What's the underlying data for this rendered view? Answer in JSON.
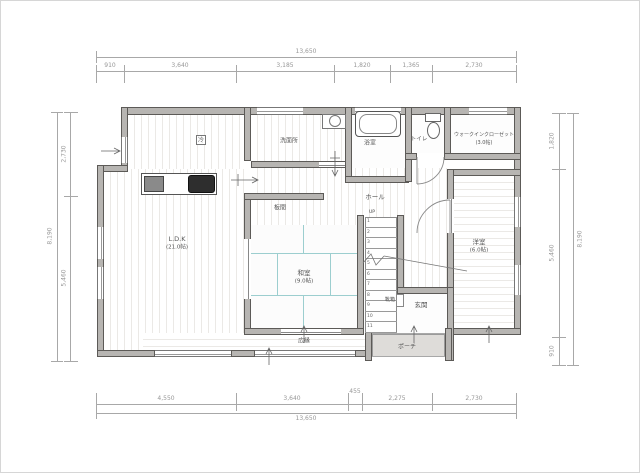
{
  "dimensions": {
    "top": {
      "total": "13,650",
      "segments": [
        "910",
        "3,640",
        "3,185",
        "1,820",
        "1,365",
        "2,730"
      ]
    },
    "bottom": {
      "total": "13,650",
      "segments": [
        "4,550",
        "3,640",
        "455",
        "2,275",
        "2,730"
      ]
    },
    "left": {
      "total": "8,190",
      "segments": [
        "2,730",
        "5,460"
      ]
    },
    "right": {
      "total": "8,190",
      "segments": [
        "1,820",
        "5,460",
        "910"
      ]
    }
  },
  "rooms": {
    "ldk": {
      "name": "L.D.K",
      "size": "(21.0帖)"
    },
    "washitsu": {
      "name": "和室",
      "size": "(9.0帖)"
    },
    "youshitsu": {
      "name": "洋室",
      "size": "(6.0帖)"
    },
    "wic": {
      "name": "ウォークインクローゼット",
      "size": "(3.0帖)"
    },
    "senmenjo": {
      "name": "洗面所"
    },
    "yokushitsu": {
      "name": "浴室"
    },
    "toilet": {
      "name": "トイレ"
    },
    "hall": {
      "name": "ホール"
    },
    "itanoma": {
      "name": "板間"
    },
    "genkan": {
      "name": "玄関"
    },
    "kutsubako": {
      "name": "靴箱"
    },
    "porch": {
      "name": "ポーチ"
    },
    "hiroen": {
      "name": "広縁"
    },
    "kitchen_marker": "冷"
  },
  "stairs": {
    "up_label": "UP",
    "steps": [
      "1",
      "2",
      "3",
      "4",
      "5",
      "6",
      "7",
      "8",
      "9",
      "10",
      "11"
    ]
  },
  "colors": {
    "wall": "#b7b5b2",
    "wall_edge": "#5c5a57",
    "tatami": "#9ccecf",
    "dim_text": "#979797",
    "floor_stripe": "#ebe9e6",
    "porch": "#dedcd9"
  }
}
